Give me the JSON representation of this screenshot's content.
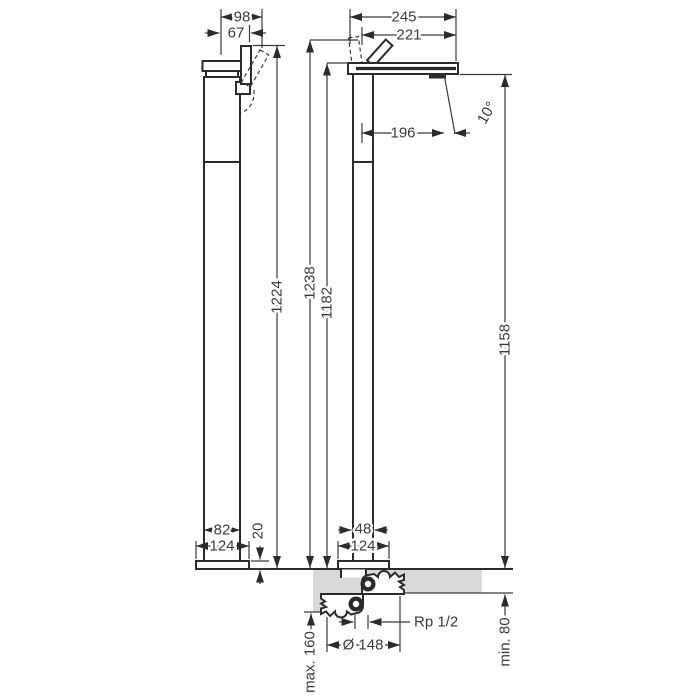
{
  "meta": {
    "drawing_type": "technical dimensional drawing, two views of a floor-standing bath mixer",
    "background_color": "#ffffff",
    "line_color": "#2b2b2b",
    "floor_color": "#d9d9d9",
    "text_color": "#3a3a3a"
  },
  "side_view": {
    "depth_top": "98",
    "depth_handle": "67",
    "height_total": "1224",
    "body_depth": "82",
    "base_depth": "124",
    "base_height": "20"
  },
  "front_view": {
    "spout_reach_total": "245",
    "spout_reach": "221",
    "spout_outlet_offset": "196",
    "outlet_angle": "10°",
    "height_handle": "1238",
    "height_spout_top": "1182",
    "height_outlet": "1158",
    "body_width": "48",
    "base_width": "124"
  },
  "installation": {
    "flange_diameter": "Ø 148",
    "connection_thread": "Rp 1/2",
    "max_recess": "max. 160",
    "min_depth": "min. 80"
  }
}
